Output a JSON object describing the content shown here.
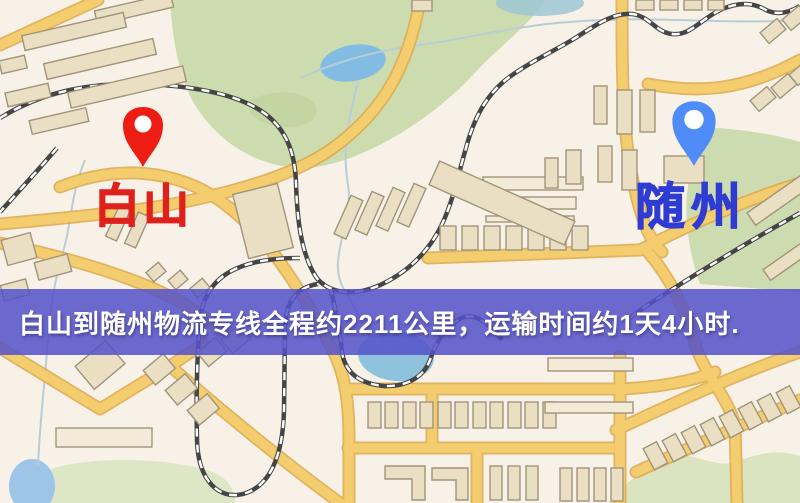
{
  "map": {
    "markers": {
      "origin": {
        "name": "白山",
        "pin_color": "#ee1d13",
        "label_color": "#e0201a"
      },
      "destination": {
        "name": "随州",
        "pin_color": "#4f8cf7",
        "label_color": "#2f3cd4"
      }
    },
    "banner": {
      "text": "白山到随州物流专线全程约2211公里，运输时间约1天4小时.",
      "background_color": "#5553c9",
      "text_color": "#ffffff",
      "distance_km": "2211",
      "duration": "1天4小时"
    }
  }
}
